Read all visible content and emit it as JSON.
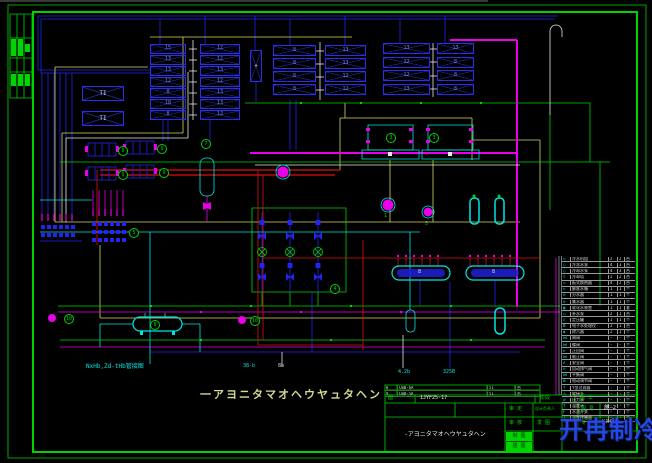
{
  "colors": {
    "green": "#00d400",
    "blue": "#2424f0",
    "cyan": "#00e5e5",
    "magenta": "#e800e8",
    "red": "#dd1111",
    "yellow": "#d8d858",
    "white": "#e8e8e8"
  },
  "drawing_title": "一アヨニタマオヘウヤュタヘン",
  "banks": {
    "unit_label": "+",
    "ti_top": "TI",
    "ti_bottom": "TI",
    "a": {
      "rows": [
        {
          "l": "15",
          "r": "12"
        },
        {
          "l": "13",
          "r": "12"
        },
        {
          "l": "13",
          "r": "13"
        },
        {
          "l": "12",
          "r": "12"
        },
        {
          "l": "8",
          "r": "13"
        },
        {
          "l": "18",
          "r": "13"
        },
        {
          "l": "8",
          "r": "12"
        }
      ]
    },
    "b": {
      "rows": [
        {
          "l": "8",
          "r": "13"
        },
        {
          "l": "8",
          "r": "13"
        },
        {
          "l": "8",
          "r": "12"
        },
        {
          "l": "8",
          "r": "12"
        }
      ]
    },
    "c": {
      "rows": [
        {
          "l": "13",
          "r": "13"
        },
        {
          "l": "12",
          "r": "8"
        },
        {
          "l": "12",
          "r": "8"
        },
        {
          "l": "13",
          "r": "8"
        }
      ]
    }
  },
  "tags": {
    "hx1": "9",
    "hx2": "9",
    "hx3": "9",
    "hx4": "9",
    "tank": "7",
    "ch1": "3",
    "ch2": "3",
    "manifold": "5",
    "grid": "4",
    "pump_left": "10",
    "pump_right": "10",
    "bottom_tank": "8"
  },
  "pump_labels": {
    "p1": "1",
    "p2": "5"
  },
  "tank_labels": {
    "t1": "8",
    "t2": "8"
  },
  "notes": {
    "pipe_note": "NxHb,Zd-tHb管接图",
    "lbl1": "38-b",
    "lbl2": "8b",
    "lbl3": "4.2b",
    "lbl4": "325B"
  },
  "legend": {
    "rows": [
      {
        "s": "▭",
        "n": "冷水机组",
        "a": "2",
        "b": "2",
        "c": "台"
      },
      {
        "s": "○",
        "n": "冷冻水泵",
        "a": "4",
        "b": "3",
        "c": "台"
      },
      {
        "s": "○",
        "n": "冷却水泵",
        "a": "4",
        "b": "3",
        "c": "台"
      },
      {
        "s": "▽",
        "n": "冷却塔",
        "a": "2",
        "b": "2",
        "c": "台"
      },
      {
        "s": "▭",
        "n": "板式换热器",
        "a": "4",
        "b": "2",
        "c": "台"
      },
      {
        "s": "◇",
        "n": "膨胀水箱",
        "a": "1",
        "b": "1",
        "c": "个"
      },
      {
        "s": "⊖",
        "n": "分水器",
        "a": "1",
        "b": "1",
        "c": "个"
      },
      {
        "s": "⊖",
        "n": "集水器",
        "a": "1",
        "b": "1",
        "c": "个"
      },
      {
        "s": "▣",
        "n": "软化水装置",
        "a": "1",
        "b": "1",
        "c": "套"
      },
      {
        "s": "○",
        "n": "补水泵",
        "a": "2",
        "b": "1",
        "c": "台"
      },
      {
        "s": "▯",
        "n": "定压罐",
        "a": "1",
        "b": "1",
        "c": "个"
      },
      {
        "s": "Ø",
        "n": "电子水处理仪",
        "a": "2",
        "b": "1",
        "c": "台"
      },
      {
        "s": "◆",
        "n": "除污器",
        "a": "2",
        "b": "1",
        "c": "个"
      },
      {
        "s": "⋈",
        "n": "闸阀",
        "a": "-",
        "b": "-",
        "c": "个"
      },
      {
        "s": "⋈",
        "n": "蝶阀",
        "a": "-",
        "b": "-",
        "c": "个"
      },
      {
        "s": "⊳",
        "n": "止回阀",
        "a": "-",
        "b": "-",
        "c": "个"
      },
      {
        "s": "⋈",
        "n": "截止阀",
        "a": "-",
        "b": "-",
        "c": "个"
      },
      {
        "s": "≭",
        "n": "安全阀",
        "a": "-",
        "b": "-",
        "c": "个"
      },
      {
        "s": "⊙",
        "n": "自动排气阀",
        "a": "-",
        "b": "-",
        "c": "个"
      },
      {
        "s": "⋈",
        "n": "平衡阀",
        "a": "-",
        "b": "-",
        "c": "个"
      },
      {
        "s": "⊠",
        "n": "电动调节阀",
        "a": "-",
        "b": "-",
        "c": "个"
      },
      {
        "s": "Y",
        "n": "Y型过滤器",
        "a": "-",
        "b": "-",
        "c": "个"
      },
      {
        "s": "∿",
        "n": "软接头",
        "a": "-",
        "b": "-",
        "c": "个"
      },
      {
        "s": "⌀",
        "n": "压力表",
        "a": "-",
        "b": "-",
        "c": "个"
      },
      {
        "s": "†",
        "n": "温度计",
        "a": "-",
        "b": "-",
        "c": "个"
      },
      {
        "s": "F",
        "n": "水流开关",
        "a": "-",
        "b": "-",
        "c": "个"
      },
      {
        "s": "T",
        "n": "温度传感器",
        "a": "-",
        "b": "-",
        "c": "个"
      }
    ]
  },
  "schedule_tail": {
    "rows": [
      {
        "i": "8",
        "n": "CWB-6A",
        "q": "51",
        "u": "台"
      },
      {
        "i": "9",
        "n": "CWB-5A",
        "q": "51",
        "u": "台"
      }
    ]
  },
  "strip": {
    "c1": "图",
    "c2": "1JYF25-17",
    "c3": "阶段",
    "c4": "施 工"
  },
  "title_block": {
    "title": "-アヨニタマオヘウヤュタヘン",
    "r1c1": "审 定",
    "r2c1": "审 核",
    "g1": "制 图",
    "g2": "描 图",
    "r1c2": "设计负责人",
    "r2c2": "发 图",
    "r1c3": "图 号",
    "r2c3": "专 业",
    "v1": "施—2",
    "v2": "KJHT75"
  },
  "watermark": {
    "text": "开冉制冷"
  }
}
